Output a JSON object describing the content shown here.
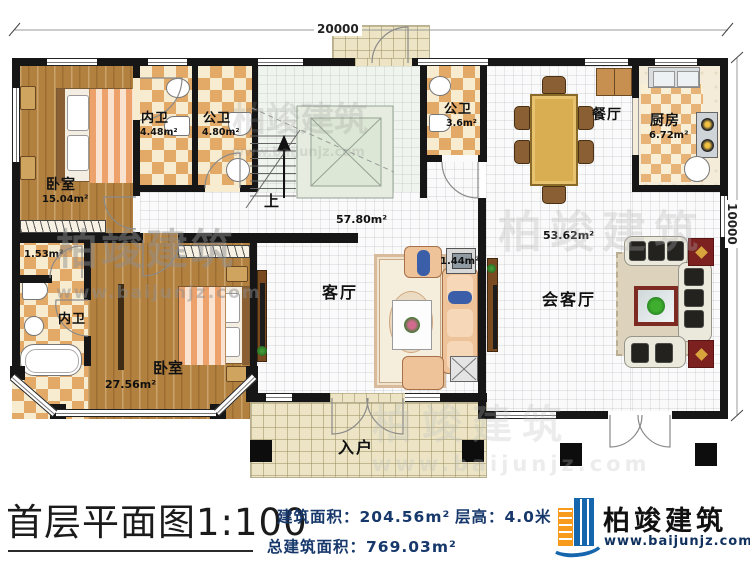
{
  "watermark": {
    "text": "柏竣建筑",
    "url": "www.baijunjz.com"
  },
  "dimensions": {
    "top": "20000",
    "right": "10000"
  },
  "rooms": {
    "bedroom1": {
      "name": "卧室",
      "area": "15.04m²"
    },
    "ensuite1": {
      "name": "内卫",
      "area": "4.48m²"
    },
    "bath1": {
      "name": "公卫",
      "area": "4.80m²"
    },
    "bath2": {
      "name": "公卫",
      "area": "3.6m²"
    },
    "dining": {
      "name": "餐厅"
    },
    "kitchen": {
      "name": "厨房",
      "area": "6.72m²"
    },
    "living": {
      "name": "客厅",
      "area": "57.80m²"
    },
    "reception": {
      "name": "会客厅",
      "area": "53.62m²"
    },
    "bedroom2": {
      "name": "卧室",
      "area": "27.56m²"
    },
    "ensuite2": {
      "name": "内卫"
    },
    "closet": {
      "area": "1.53m²"
    },
    "shaft": {
      "area": "1.44m²"
    },
    "entry": {
      "name": "入户"
    },
    "stairs": {
      "up": "上"
    }
  },
  "footer": {
    "title": "首层平面图1:100",
    "building_area": "建筑面积：204.56m²",
    "floor_height": "层高：4.0米",
    "total_area": "总建筑面积：769.03m²",
    "brand_name": "柏竣建筑",
    "brand_url": "www.baijunjz.com"
  }
}
